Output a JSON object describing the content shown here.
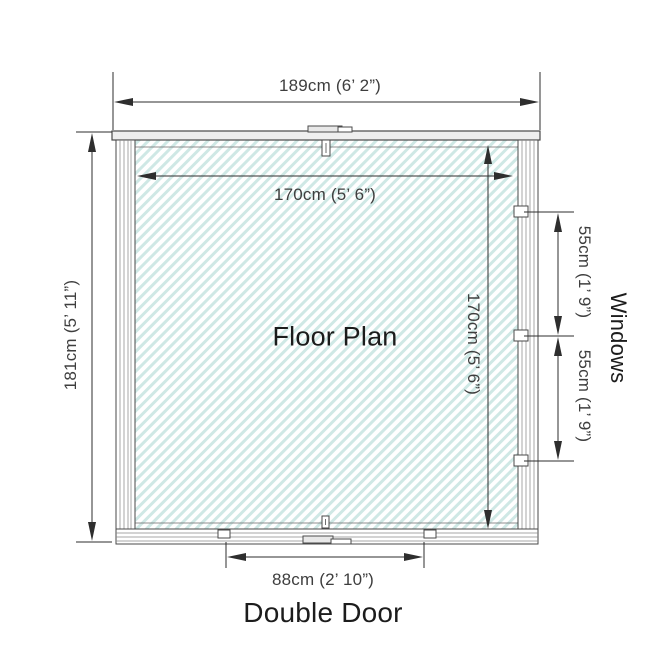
{
  "diagram": {
    "title": "Floor Plan",
    "dimensions": {
      "overall_width": "189cm (6’ 2”)",
      "overall_depth": "181cm (5’ 11”)",
      "internal_width": "170cm (5’ 6”)",
      "internal_depth": "170cm (5’ 6”)",
      "window_top": "55cm (1’ 9”)",
      "window_bottom": "55cm (1’ 9”)",
      "door_width": "88cm (2’ 10”)"
    },
    "labels": {
      "windows": "Windows",
      "double_door": "Double Door"
    },
    "colors": {
      "hatch": "#cfe8e5",
      "wall_line": "#4a4a4a",
      "dim_line": "#2e2e2e",
      "dim_text": "#3e3e3e",
      "label_text": "#1c1c1c"
    }
  }
}
